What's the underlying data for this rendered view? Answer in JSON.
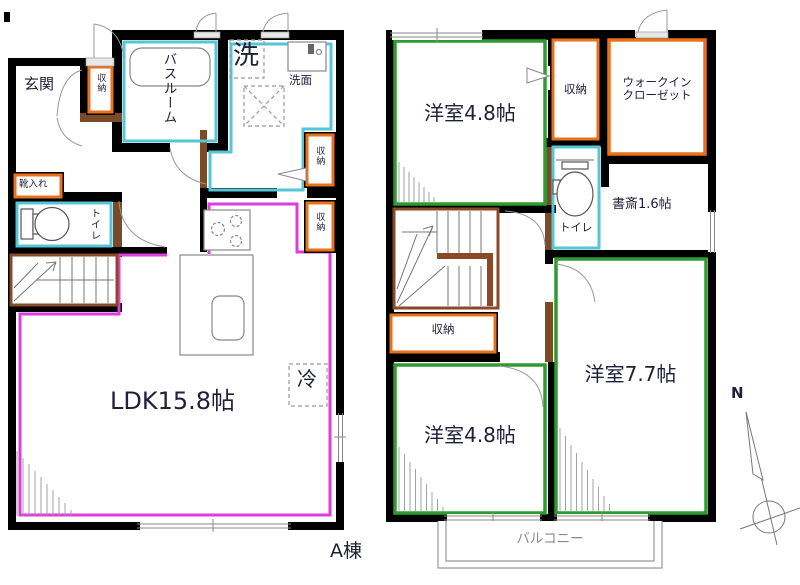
{
  "title": "A棟",
  "compass_north": "N",
  "floor1": {
    "entrance": "玄関",
    "entrance_storage": "収納",
    "shoe_storage": "靴入れ",
    "bathroom": "バスルーム",
    "laundry": "洗",
    "washstand": "洗面",
    "washroom_storage": "収納",
    "kitchen_storage": "収納",
    "toilet": "トイレ",
    "ldk": "LDK15.8帖",
    "refrigerator": "冷"
  },
  "floor2": {
    "room_northwest": "洋室4.8帖",
    "storage_north": "収納",
    "walkin_closet_line1": "ウォークイン",
    "walkin_closet_line2": "クローゼット",
    "toilet": "トイレ",
    "study": "書斎1.6帖",
    "stair_storage": "収納",
    "room_southwest": "洋室4.8帖",
    "room_southeast": "洋室7.7帖",
    "balcony": "バルコニー"
  },
  "colors": {
    "wall": "#000000",
    "wall_accent": "#7b4a26",
    "wet_area_outline": "#55c6d6",
    "ldk_outline": "#dd3edd",
    "bedroom_outline": "#2e9b30",
    "storage_outline": "#e8721c",
    "stairs_outline": "#8a4a28"
  }
}
